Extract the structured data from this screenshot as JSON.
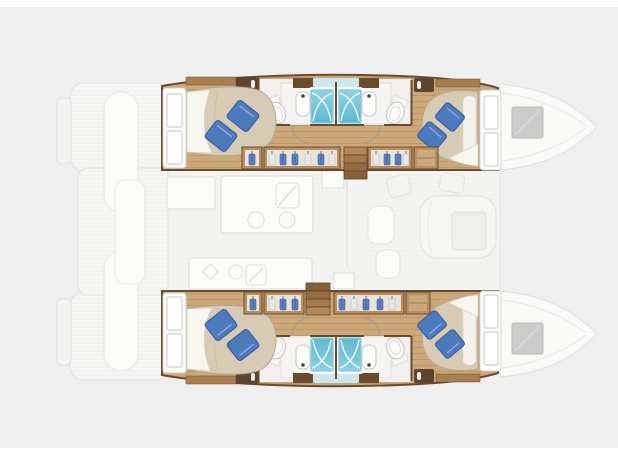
{
  "diagram": {
    "type": "catamaran floor plan, top view",
    "orientation": "bows pointing right, transoms left",
    "highlighted_layout": "4 double cabins and 4 shower bathrooms inside the two hulls",
    "ghosted_areas": [
      "transom steps and cockpit (left)",
      "saloon and galley on bridgedeck (center)",
      "foredecks with deck hatches (right)"
    ],
    "counts": {
      "cabins": 4,
      "bathrooms": 4,
      "showers": 4,
      "double_beds": 4,
      "wardrobes": 8,
      "companionway_stairs": 2
    },
    "rooms": {
      "port_hull": [
        "aft-double-cabin",
        "aft-head-with-shower",
        "forward-head-with-shower",
        "forward-double-cabin"
      ],
      "starboard_hull": [
        "aft-double-cabin",
        "aft-head-with-shower",
        "forward-head-with-shower",
        "forward-double-cabin"
      ]
    }
  },
  "palette": {
    "bg": "#efefef",
    "frame": "#ffffff",
    "ghostFill": "#f6f6f5",
    "ghostStroke": "#e0e0de",
    "ghostDetail": "#fbfbfa",
    "saloonFloor": "#f4f4f3",
    "wood": "#cda87a",
    "woodLine": "#bf9866",
    "woodMid": "#b98f5f",
    "woodShelf": "#a97f52",
    "wall": "#6b4b2f",
    "cabinetDark": "#5c4430",
    "duvet": "#d8cbb5",
    "duvetShade": "#c9bba1",
    "sheet": "#f8f6f1",
    "pillow": "#4d79bd",
    "pillowDark": "#2e5a9e",
    "pillowLight": "#8fb0dd",
    "showerLight": "#aadee9",
    "showerDeep": "#5fb9d0",
    "showerPane": "#8ed2e2",
    "bathFloor": "#f1f0ee",
    "fixtureWhite": "#fcfcfb",
    "fixtureStroke": "#c9c6c1",
    "counter": "#f6f5f3",
    "hatch": "#cccccb",
    "hatchStroke": "#b9b9b7",
    "mirrorBlue": "#cfe6ec",
    "garmentBlue": "#5b83c0",
    "garmentBlueDark": "#35598f",
    "garmentLight": "#e8e8ea",
    "garmentLightStroke": "#bcbcc0",
    "closetInner": "#e9e3da",
    "doorArc": "#9a9a98"
  }
}
